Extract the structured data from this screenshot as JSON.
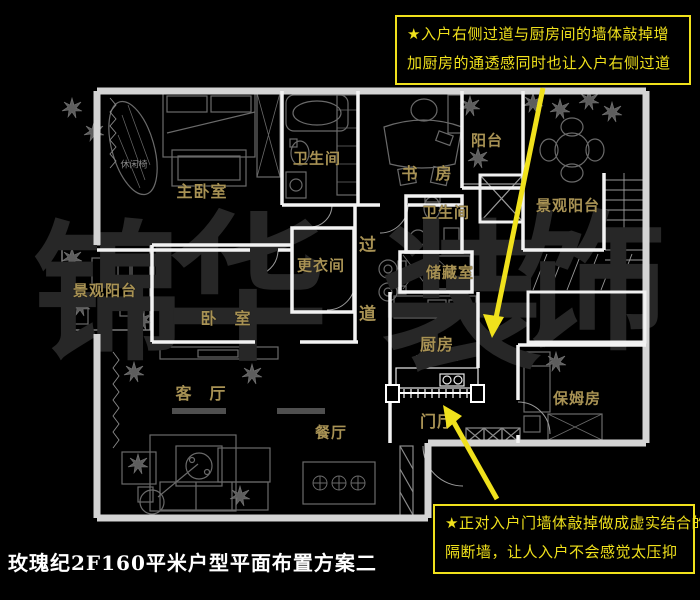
{
  "title": "玫瑰纪2F160平米户型平面布置方案二",
  "watermark": {
    "chars": [
      "锦",
      "华",
      "装",
      "饰"
    ]
  },
  "callouts": {
    "top": {
      "line1": "★入户右侧过道与厨房间的墙体敲掉增",
      "line2": "加厨房的通透感同时也让入户右侧过道"
    },
    "bottom": {
      "line1": "★正对入户门墙体敲掉做成虚实结合的",
      "line2": "隔断墙，让人入户不会感觉太压抑"
    }
  },
  "rooms": [
    {
      "id": "master-bedroom",
      "label": "主卧室"
    },
    {
      "id": "bathroom-1",
      "label": "卫生间"
    },
    {
      "id": "study",
      "label": "书　房"
    },
    {
      "id": "balcony-top",
      "label": "阳台"
    },
    {
      "id": "scenic-balcony-right",
      "label": "景观阳台"
    },
    {
      "id": "bathroom-2",
      "label": "卫生间"
    },
    {
      "id": "dressing-room",
      "label": "更衣间"
    },
    {
      "id": "corridor-top-char",
      "label": "过"
    },
    {
      "id": "corridor-bottom-char",
      "label": "道"
    },
    {
      "id": "storage-room",
      "label": "储藏室"
    },
    {
      "id": "scenic-balcony-left",
      "label": "景观阳台"
    },
    {
      "id": "bedroom-2",
      "label": "卧　室"
    },
    {
      "id": "kitchen",
      "label": "厨房"
    },
    {
      "id": "living-room",
      "label": "客　厅"
    },
    {
      "id": "dining-room",
      "label": "餐厅"
    },
    {
      "id": "foyer",
      "label": "门厅"
    },
    {
      "id": "nanny-room",
      "label": "保姆房"
    },
    {
      "id": "leisure-chair",
      "label": "休闲椅"
    }
  ],
  "colors": {
    "background": "#000000",
    "outer_wall": "#d4d4d4",
    "inner_wall": "#f3f3f3",
    "furniture_line": "#6a6a6a",
    "room_label_gold": "#a89254",
    "callout_yellow": "#f0e11c",
    "watermark_gray": "#272727",
    "title_white": "#ffffff"
  }
}
